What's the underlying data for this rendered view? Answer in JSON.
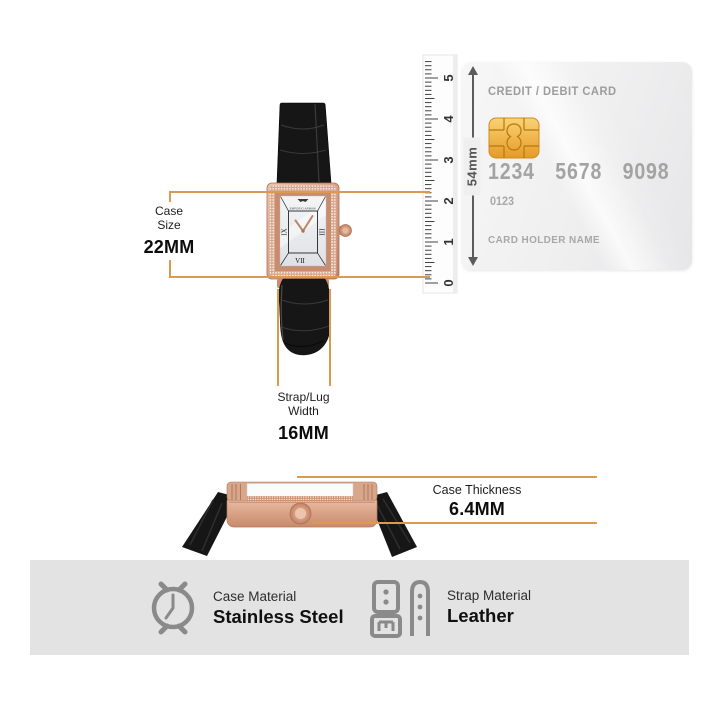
{
  "annotations": {
    "case_size": {
      "line1": "Case",
      "line2": "Size",
      "value": "22MM"
    },
    "strap_width": {
      "line1": "Strap/Lug",
      "line2": "Width",
      "value": "16MM"
    },
    "case_thickness": {
      "label": "Case Thickness",
      "value": "6.4MM"
    }
  },
  "ruler": {
    "numbers": [
      "0",
      "1",
      "2",
      "3",
      "4",
      "5"
    ],
    "height_label": "54mm"
  },
  "card": {
    "title": "CREDIT / DEBIT CARD",
    "digits": [
      "1234",
      "5678",
      "9098"
    ],
    "aux_digits": "0123",
    "holder": "CARD HOLDER NAME"
  },
  "dial": {
    "brand": "EMPORIO ARMANI",
    "numerals": {
      "left": "IX",
      "right": "III",
      "bottom": "VII"
    }
  },
  "specs": {
    "case_material": {
      "label": "Case Material",
      "value": "Stainless Steel"
    },
    "strap_material": {
      "label": "Strap Material",
      "value": "Leather"
    }
  },
  "icons": {
    "spec_case": "watch-case-icon",
    "spec_strap": "watch-strap-icon",
    "chip": "card-chip-icon",
    "height_arrow": "double-arrow-vertical-icon",
    "ruler": "ruler-scale"
  },
  "colors": {
    "accent_line": "#DB9A52",
    "rose_gold": "#D49A82",
    "chip_gold": "#EDAE3C",
    "band_bg": "#E3E3E3",
    "card_text": "#A6A6A6",
    "icon_gray": "#8A8A8A",
    "strap_black": "#161616"
  }
}
